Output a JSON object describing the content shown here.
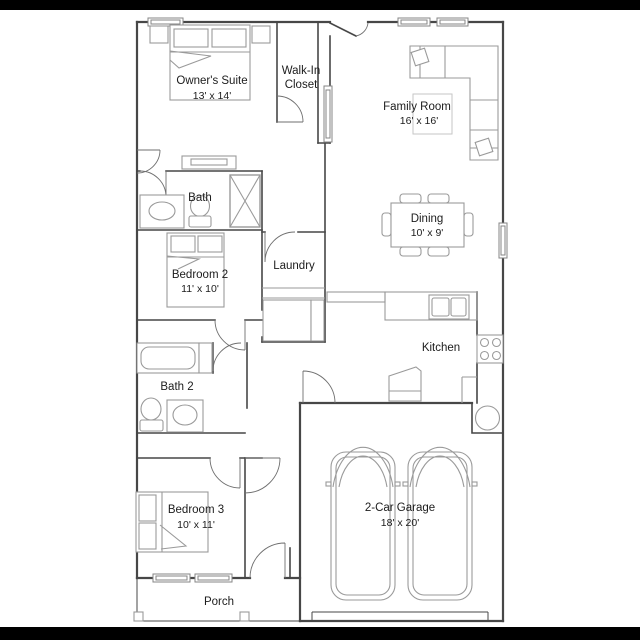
{
  "title": "Single-story house floor plan",
  "colors": {
    "background": "#ffffff",
    "letterbox": "#000000",
    "wall": "#474747",
    "furniture": "#9a9a9a",
    "furniture_light": "#c6c6c6",
    "text": "#1c1c1c"
  },
  "rooms": {
    "owners_suite": {
      "name": "Owner's Suite",
      "dims": "13' x 14'"
    },
    "walk_in_closet": {
      "line1": "Walk-In",
      "line2": "Closet"
    },
    "family_room": {
      "name": "Family Room",
      "dims": "16' x 16'"
    },
    "bath": {
      "name": "Bath"
    },
    "dining": {
      "name": "Dining",
      "dims": "10' x 9'"
    },
    "bedroom2": {
      "name": "Bedroom 2",
      "dims": "11' x 10'"
    },
    "laundry": {
      "name": "Laundry"
    },
    "kitchen": {
      "name": "Kitchen"
    },
    "bath2": {
      "name": "Bath 2"
    },
    "bedroom3": {
      "name": "Bedroom 3",
      "dims": "10' x 11'"
    },
    "garage": {
      "name": "2-Car Garage",
      "dims": "18' x 20'"
    },
    "porch": {
      "name": "Porch"
    }
  },
  "fixtures": {
    "bed-icon": "svg-shape",
    "nightstand-icon": "svg-shape",
    "dresser-icon": "svg-shape",
    "sofa-icon": "svg-shape",
    "coffee-table-icon": "svg-shape",
    "dining-table-icon": "svg-shape",
    "chair-icon": "svg-shape",
    "toilet-icon": "svg-shape",
    "sink-icon": "svg-shape",
    "bathtub-icon": "svg-shape",
    "shower-icon": "svg-x-box",
    "washer-dryer-icon": "svg-shape",
    "kitchen-sink-icon": "svg-shape",
    "stove-icon": "svg-circles",
    "island-icon": "svg-shape",
    "water-heater-icon": "svg-circle",
    "car-icon": "svg-shape",
    "window-icon": "svg-double-rect",
    "door-arc-icon": "svg-arc",
    "porch-post-icon": "svg-square"
  }
}
